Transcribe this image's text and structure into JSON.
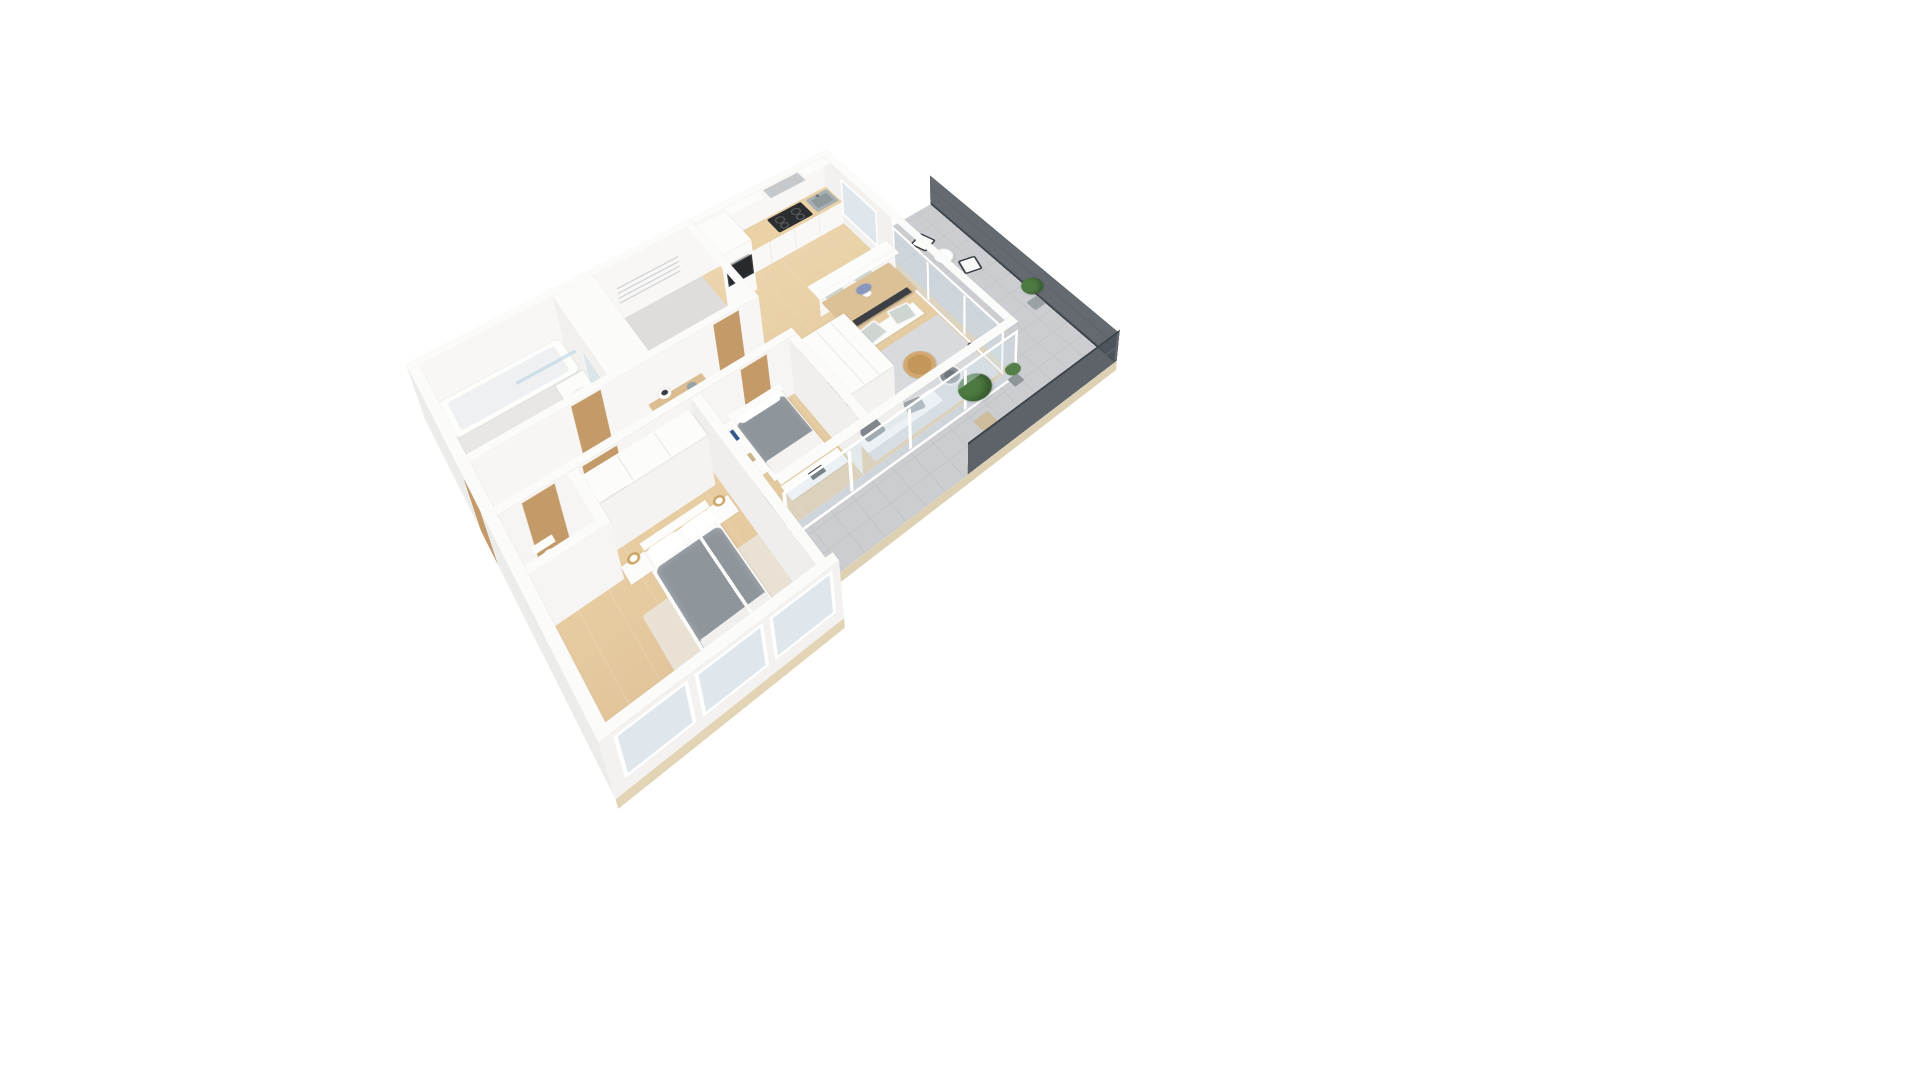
{
  "scene": {
    "type": "3d-floor-plan-rendering",
    "description": "Photorealistic isometric 3D floor plan of a two-bedroom apartment with balcony, viewed from above at an angle, centered on a plain white background",
    "background_color": "#ffffff",
    "visible_text": ""
  },
  "palette": {
    "wall_white": "#fbfbfa",
    "wall_face_shade": "#efeeec",
    "wood_floor": "#e8d0a8",
    "bedroom_wood_floor": "#e6c9a0",
    "bathroom_tile": "#e9e7e4",
    "terrace_tile": "#cbcdd0",
    "rug_gray": "#d8dade",
    "rug_beige": "#e9e2d4",
    "duvet_gray": "#8e959b",
    "sofa_cushion_gray": "#7f868c",
    "furniture_wood": "#dcc096",
    "door_wood": "#c49a68",
    "glass": "rgba(205,222,233,0.45)",
    "railing_dark": "#4a5058",
    "plant_green": "#4c7a40",
    "cooktop_black": "#2b2d30",
    "lamp_gold": "#caa35e",
    "flower_blue": "#8a97bd"
  },
  "rooms": {
    "bathroom": {
      "label": "Bathroom",
      "furniture": [
        "bathtub with glass shower screen",
        "toilet",
        "washbasin counter",
        "wall mirror"
      ]
    },
    "utility": {
      "label": "Utility storage room",
      "furniture": [
        "wall-mounted drying racks"
      ]
    },
    "kitchen": {
      "label": "Kitchen",
      "furniture": [
        "tall oven cabinet",
        "wood worktop",
        "induction cooktop",
        "range hood",
        "gray sink",
        "upper cabinets",
        "breakfast bar half-wall",
        "two bar stools"
      ]
    },
    "hallway": {
      "label": "Entrance hallway",
      "furniture": [
        "entrance door",
        "console table",
        "table lamp",
        "decor bowl",
        "interior doors"
      ]
    },
    "living_dining": {
      "label": "Living and dining room",
      "furniture": [
        "dining table",
        "four chairs",
        "flower vase",
        "white wardrobe",
        "gray area rug",
        "sofa with gray cushions",
        "round coffee table",
        "TV on media console",
        "armchair",
        "floor lamp"
      ]
    },
    "bedroom1": {
      "label": "Bedroom with desk",
      "furniture": [
        "single bed with gray duvet",
        "white shelf unit",
        "desk",
        "office chair"
      ]
    },
    "master_bedroom": {
      "label": "Master bedroom",
      "furniture": [
        "double bed with gray duvet",
        "two nightstands",
        "two gold lamps",
        "three-door wardrobe",
        "beige rug",
        "window wall"
      ]
    },
    "wc": {
      "label": "Guest WC",
      "furniture": [
        "toilet"
      ]
    },
    "balcony": {
      "label": "Balcony terrace",
      "furniture": [
        "two outdoor chairs",
        "round side table",
        "potted plants",
        "potted tree",
        "dark railing"
      ]
    }
  }
}
